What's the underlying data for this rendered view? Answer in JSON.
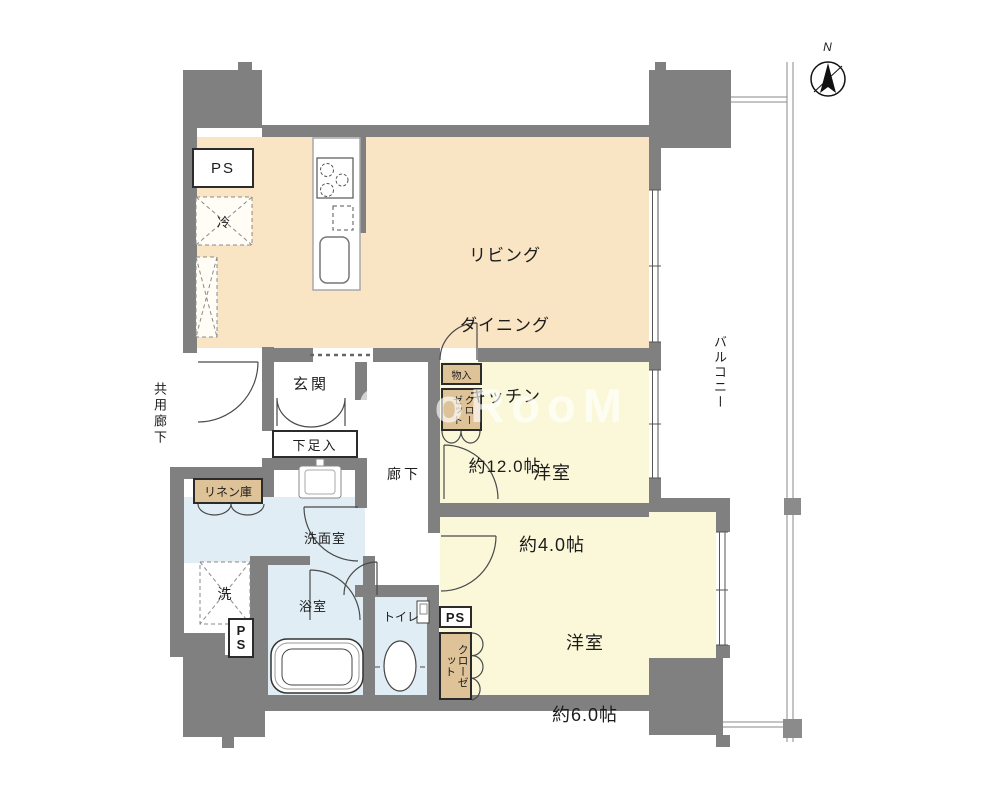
{
  "plan": {
    "compass": {
      "label": "N"
    },
    "watermark": "CooRooM",
    "rooms": {
      "ldk": {
        "label_lines": [
          "リビング",
          "ダイニング",
          "キッチン",
          "約12.0帖"
        ]
      },
      "bedroom4": {
        "name": "洋室",
        "size": "約4.0帖"
      },
      "bedroom6": {
        "name": "洋室",
        "size": "約6.0帖"
      },
      "entrance": {
        "label": "玄関"
      },
      "hallway": {
        "label": "廊下"
      },
      "washroom": {
        "label": "洗面室"
      },
      "bathroom": {
        "label": "浴室"
      },
      "toilet": {
        "label": "トイレ"
      },
      "balcony": {
        "label": "バルコニー"
      },
      "common_corridor": {
        "label": "共用廊下"
      }
    },
    "fixtures": {
      "ps_top": "PS",
      "ps_bottom": "PS",
      "ps_p": "P",
      "ps_s": "S",
      "refrigerator": "冷",
      "washer": "洗",
      "shoe_cabinet": "下足入",
      "linen": "リネン庫",
      "storage": "物入",
      "closet_upper": "クローゼット",
      "closet_lower": "クローゼット"
    },
    "palette": {
      "wall": "#808080",
      "ldk": "#f9e4c4",
      "bedroom": "#fbf8da",
      "wet": "#e0edf4",
      "closet": "#dfc398"
    }
  }
}
